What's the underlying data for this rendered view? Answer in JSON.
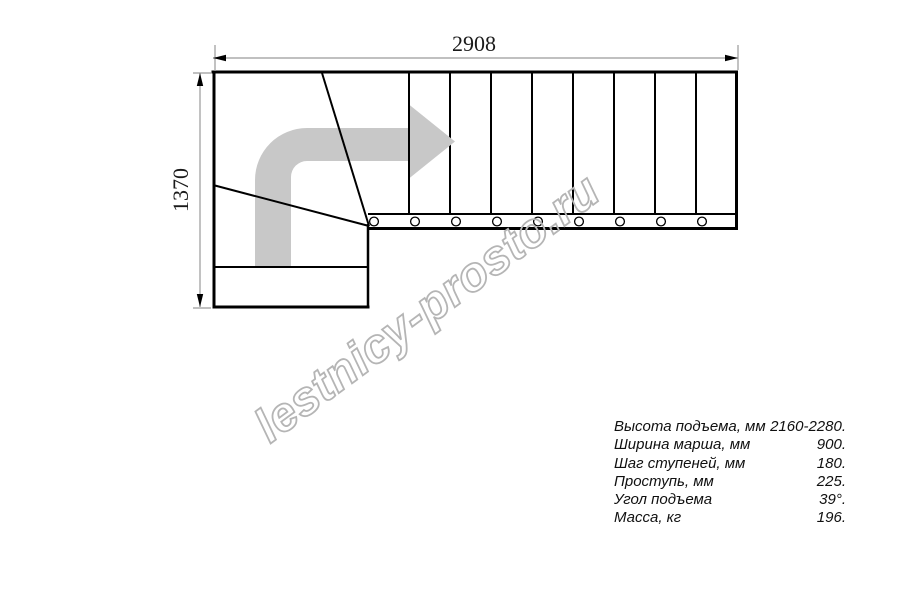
{
  "dimensions": {
    "width": "2908",
    "height": "1370"
  },
  "watermark": {
    "text": "lestnicy-prosto.ru"
  },
  "specs": {
    "rows": [
      {
        "label": "Высота подъема, мм",
        "value": "2160-2280."
      },
      {
        "label": "Ширина марша, мм",
        "value": "900."
      },
      {
        "label": "Шаг ступеней, мм",
        "value": "180."
      },
      {
        "label": "Проступь, мм",
        "value": "225."
      },
      {
        "label": "Угол подъема",
        "value": "39°."
      },
      {
        "label": "Масса, кг",
        "value": "196."
      }
    ]
  },
  "colors": {
    "line": "#000000",
    "dim_line": "#9a9a9a",
    "arrow": "#c8c8c8",
    "watermark_stroke": "#b5b5b5"
  }
}
